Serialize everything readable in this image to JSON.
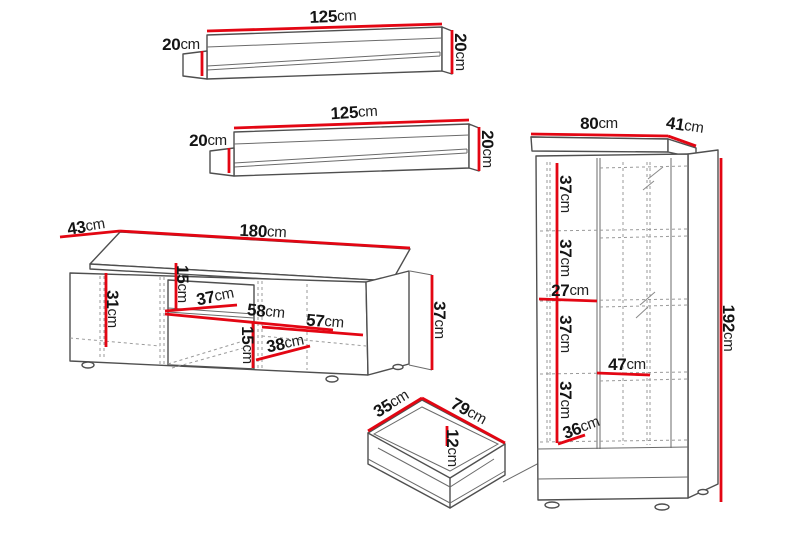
{
  "colors": {
    "dimension_red": "#e30613",
    "outline_gray": "#4f4f4f",
    "hidden_line_gray": "#9a9a9a",
    "text_black": "#141414",
    "background": "#ffffff"
  },
  "pieces": {
    "shelf1": {
      "width": {
        "num": "125",
        "unit": "cm"
      },
      "depth": {
        "num": "20",
        "unit": "cm"
      },
      "height": {
        "num": "20",
        "unit": "cm"
      }
    },
    "shelf2": {
      "width": {
        "num": "125",
        "unit": "cm"
      },
      "depth": {
        "num": "20",
        "unit": "cm"
      },
      "height": {
        "num": "20",
        "unit": "cm"
      }
    },
    "tv": {
      "depth": {
        "num": "43",
        "unit": "cm"
      },
      "width": {
        "num": "180",
        "unit": "cm"
      },
      "h31": {
        "num": "31",
        "unit": "cm"
      },
      "h15a": {
        "num": "15",
        "unit": "cm"
      },
      "w37": {
        "num": "37",
        "unit": "cm"
      },
      "w58": {
        "num": "58",
        "unit": "cm"
      },
      "w57": {
        "num": "57",
        "unit": "cm"
      },
      "h15b": {
        "num": "15",
        "unit": "cm"
      },
      "w38": {
        "num": "38",
        "unit": "cm"
      },
      "height": {
        "num": "37",
        "unit": "cm"
      }
    },
    "drawer": {
      "depth": {
        "num": "35",
        "unit": "cm"
      },
      "width": {
        "num": "79",
        "unit": "cm"
      },
      "height": {
        "num": "12",
        "unit": "cm"
      }
    },
    "cab": {
      "width": {
        "num": "80",
        "unit": "cm"
      },
      "depth": {
        "num": "41",
        "unit": "cm"
      },
      "s37a": {
        "num": "37",
        "unit": "cm"
      },
      "s37b": {
        "num": "37",
        "unit": "cm"
      },
      "w27": {
        "num": "27",
        "unit": "cm"
      },
      "s37c": {
        "num": "37",
        "unit": "cm"
      },
      "w47": {
        "num": "47",
        "unit": "cm"
      },
      "s37d": {
        "num": "37",
        "unit": "cm"
      },
      "s36": {
        "num": "36",
        "unit": "cm"
      },
      "height": {
        "num": "192",
        "unit": "cm"
      }
    }
  }
}
